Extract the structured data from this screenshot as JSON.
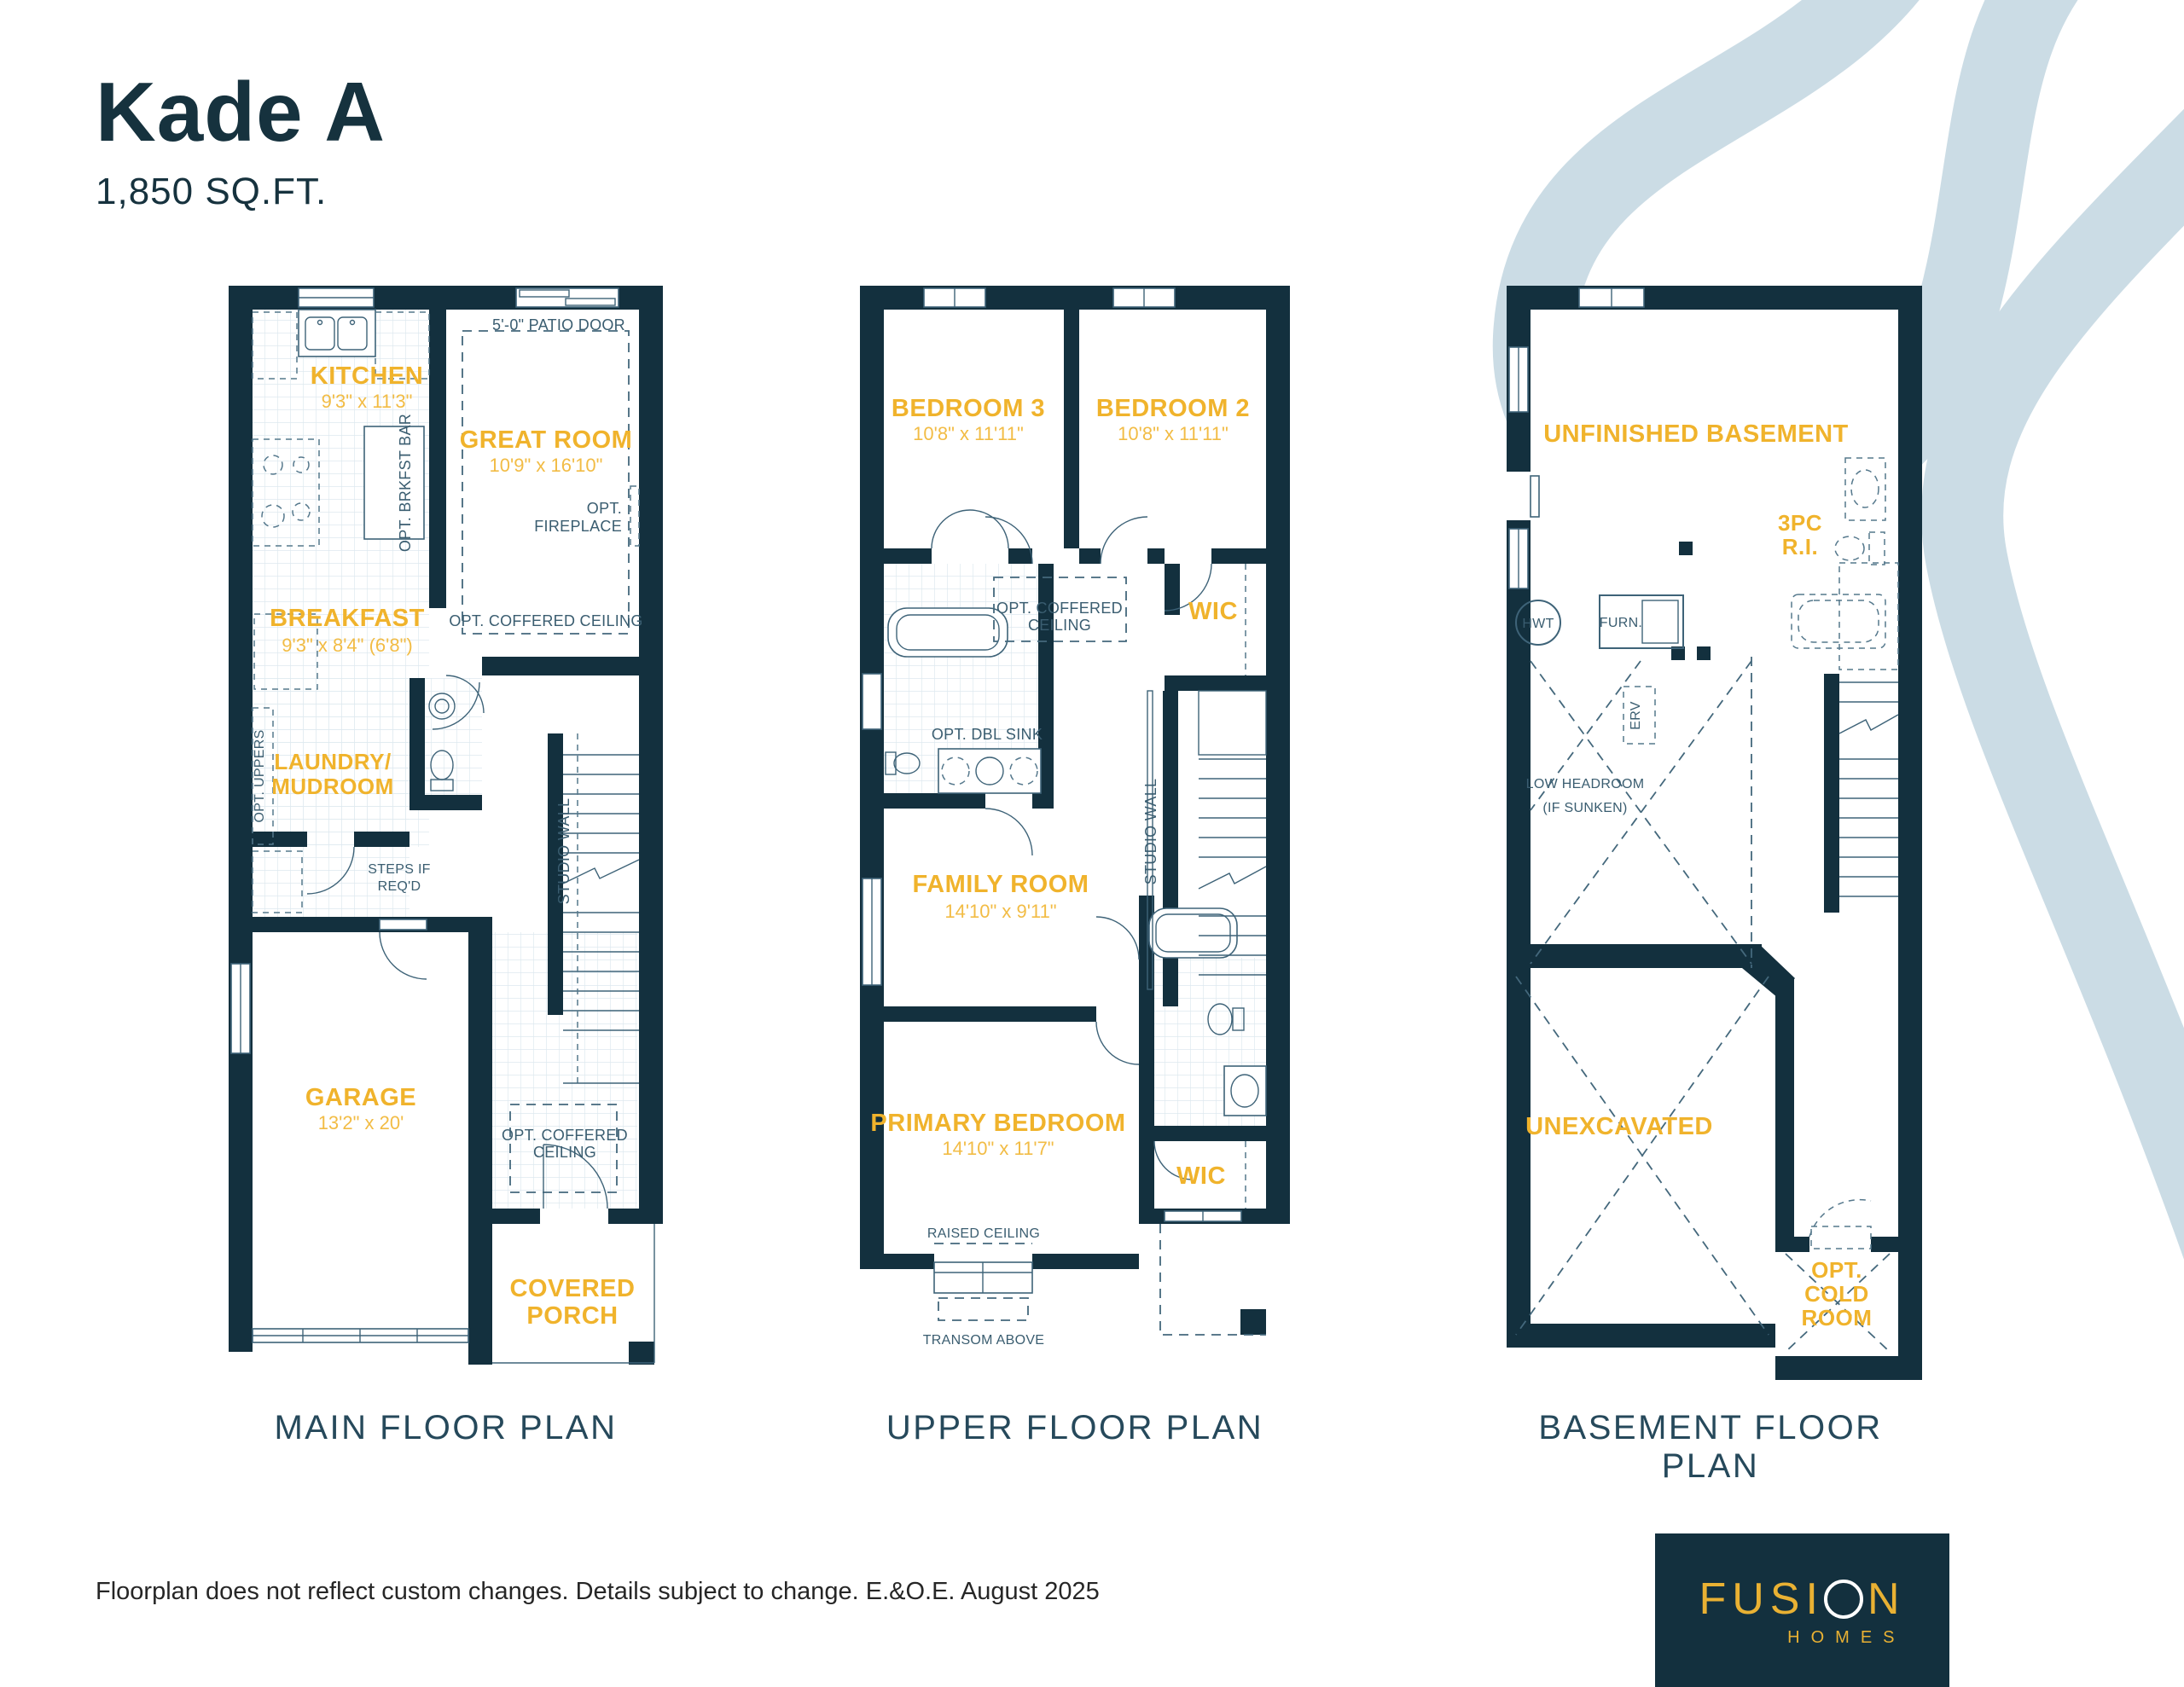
{
  "colors": {
    "navy": "#13303E",
    "yellow": "#F0B32C",
    "swirl": "#CBDCE5",
    "note_navy": "#3A5D70"
  },
  "header": {
    "title": "Kade A",
    "sqft": "1,850 SQ.FT."
  },
  "footer": {
    "disclaimer": "Floorplan does not reflect custom changes. Details subject to change. E.&O.E. August 2025"
  },
  "logo": {
    "brand_part1": "FUSI",
    "brand_part2": "N",
    "brand_sub": "HOMES"
  },
  "plans": {
    "main": {
      "title": "MAIN FLOOR PLAN",
      "rooms": {
        "kitchen": {
          "name": "KITCHEN",
          "dims": "9'3\" x 11'3\""
        },
        "great_room": {
          "name": "GREAT ROOM",
          "dims": "10'9\" x 16'10\""
        },
        "breakfast": {
          "name": "BREAKFAST",
          "dims": "9'3\" x 8'4\" (6'8\")"
        },
        "laundry": {
          "line1": "LAUNDRY/",
          "line2": "MUDROOM"
        },
        "garage": {
          "name": "GARAGE",
          "dims": "13'2\" x 20'"
        },
        "porch": {
          "line1": "COVERED",
          "line2": "PORCH"
        }
      },
      "notes": {
        "patio_door": "5'-0\" PATIO DOOR",
        "fireplace_1": "OPT.",
        "fireplace_2": "FIREPLACE",
        "coffered_great": "OPT. COFFERED CEILING",
        "brkfst_bar": "OPT. BRKFST BAR",
        "opt_uppers": "OPT. UPPERS",
        "steps_1": "STEPS IF",
        "steps_2": "REQ'D",
        "studio_wall": "STUDIO WALL",
        "coffered_foyer_1": "OPT. COFFERED",
        "coffered_foyer_2": "CEILING"
      }
    },
    "upper": {
      "title": "UPPER FLOOR PLAN",
      "rooms": {
        "bedroom3": {
          "name": "BEDROOM 3",
          "dims": "10'8\" x 11'11\""
        },
        "bedroom2": {
          "name": "BEDROOM 2",
          "dims": "10'8\" x 11'11\""
        },
        "wic_hall": {
          "name": "WIC"
        },
        "family": {
          "name": "FAMILY ROOM",
          "dims": "14'10\" x 9'11\""
        },
        "primary": {
          "name": "PRIMARY BEDROOM",
          "dims": "14'10\" x 11'7\""
        },
        "wic_primary": {
          "name": "WIC"
        }
      },
      "notes": {
        "coffered_1": "OPT. COFFERED",
        "coffered_2": "CEILING",
        "dbl_sink": "OPT. DBL SINK",
        "studio_wall": "STUDIO WALL",
        "raised_ceiling": "RAISED CEILING",
        "transom": "TRANSOM ABOVE"
      }
    },
    "basement": {
      "title": "BASEMENT FLOOR PLAN",
      "rooms": {
        "unfinished": {
          "name": "UNFINISHED BASEMENT"
        },
        "three_pc": {
          "line1": "3PC",
          "line2": "R.I."
        },
        "unexcavated": {
          "name": "UNEXCAVATED"
        },
        "cold_room": {
          "line1": "OPT.",
          "line2": "COLD",
          "line3": "ROOM"
        }
      },
      "notes": {
        "hwt": "HWT",
        "furn": "FURN.",
        "erv": "ERV",
        "low_headroom_1": "LOW HEADROOM",
        "low_headroom_2": "(IF SUNKEN)"
      }
    }
  }
}
